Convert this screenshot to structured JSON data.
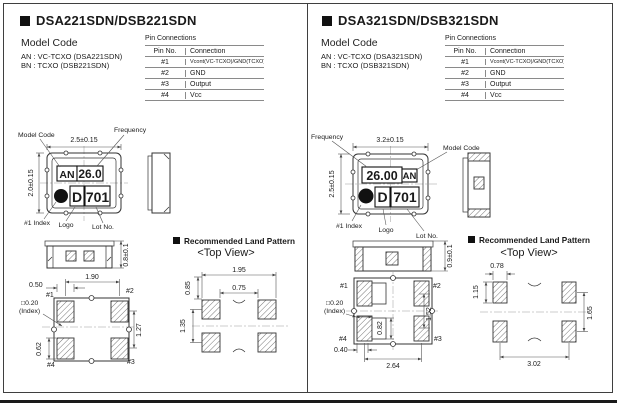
{
  "page": {
    "panels": [
      {
        "title": "DSA221SDN/DSB221SDN",
        "model_code": {
          "heading": "Model Code",
          "line1": "AN : VC-TCXO (DSA221SDN)",
          "line2": "BN : TCXO (DSB221SDN)"
        },
        "pin_connections": {
          "title": "Pin Connections",
          "col_pin": "Pin No.",
          "col_conn": "Connection",
          "rows": [
            {
              "no": "#1",
              "conn": "Vcont(VC-TCXO)/GND(TCXO)"
            },
            {
              "no": "#2",
              "conn": "GND"
            },
            {
              "no": "#3",
              "conn": "Output"
            },
            {
              "no": "#4",
              "conn": "Vcc"
            }
          ]
        },
        "top_view": {
          "width_dim": "2.5±0.15",
          "height_dim": "2.0±0.15",
          "label_model_code": "Model Code",
          "label_frequency": "Frequency",
          "label_index": "#1 Index",
          "label_logo": "Logo",
          "label_lot": "Lot No.",
          "mark_model": "AN",
          "mark_freq": "26.0",
          "mark_logo": "D",
          "mark_lot": "701"
        },
        "side_view": {
          "thickness_dim": "0.8±0.1"
        },
        "bottom_view": {
          "dim_pad_w": "0.50",
          "dim_span_x": "1.90",
          "dim_span_y": "1.27",
          "dim_pad_h": "0.62",
          "index_size": "□0.20",
          "index_word": "(Index)",
          "pin1": "#1",
          "pin2": "#2",
          "pin3": "#3",
          "pin4": "#4"
        },
        "land_pattern": {
          "title": "Recommended Land Pattern",
          "subtitle": "<Top View>",
          "dim_outer_x": "1.95",
          "dim_inner_x": "0.75",
          "dim_pad_h": "0.85",
          "dim_span_y": "1.35"
        }
      },
      {
        "title": "DSA321SDN/DSB321SDN",
        "model_code": {
          "heading": "Model Code",
          "line1": "AN : VC-TCXO (DSA321SDN)",
          "line2": "BN : TCXO (DSB321SDN)"
        },
        "pin_connections": {
          "title": "Pin Connections",
          "col_pin": "Pin No.",
          "col_conn": "Connection",
          "rows": [
            {
              "no": "#1",
              "conn": "Vcont(VC-TCXO)/GND(TCXO)"
            },
            {
              "no": "#2",
              "conn": "GND"
            },
            {
              "no": "#3",
              "conn": "Output"
            },
            {
              "no": "#4",
              "conn": "Vcc"
            }
          ]
        },
        "top_view": {
          "width_dim": "3.2±0.15",
          "height_dim": "2.5±0.15",
          "label_model_code": "Model Code",
          "label_frequency": "Frequency",
          "label_index": "#1 Index",
          "label_logo": "Logo",
          "label_lot": "Lot No.",
          "mark_model": "AN",
          "mark_freq": "26.00",
          "mark_logo": "D",
          "mark_lot": "701"
        },
        "side_view": {
          "thickness_dim": "0.9±0.1"
        },
        "bottom_view": {
          "dim_inner_w": "0.82",
          "dim_span_y": "1.52",
          "dim_pad_off": "0.40",
          "dim_span_x": "2.64",
          "index_size": "□0.20",
          "index_word": "(Index)",
          "pin1": "#1",
          "pin2": "#2",
          "pin3": "#3",
          "pin4": "#4"
        },
        "land_pattern": {
          "title": "Recommended Land Pattern",
          "subtitle": "<Top View>",
          "dim_pad_w": "0.78",
          "dim_pad_h": "1.15",
          "dim_span_y": "1.65",
          "dim_span_x": "3.02"
        }
      }
    ]
  }
}
